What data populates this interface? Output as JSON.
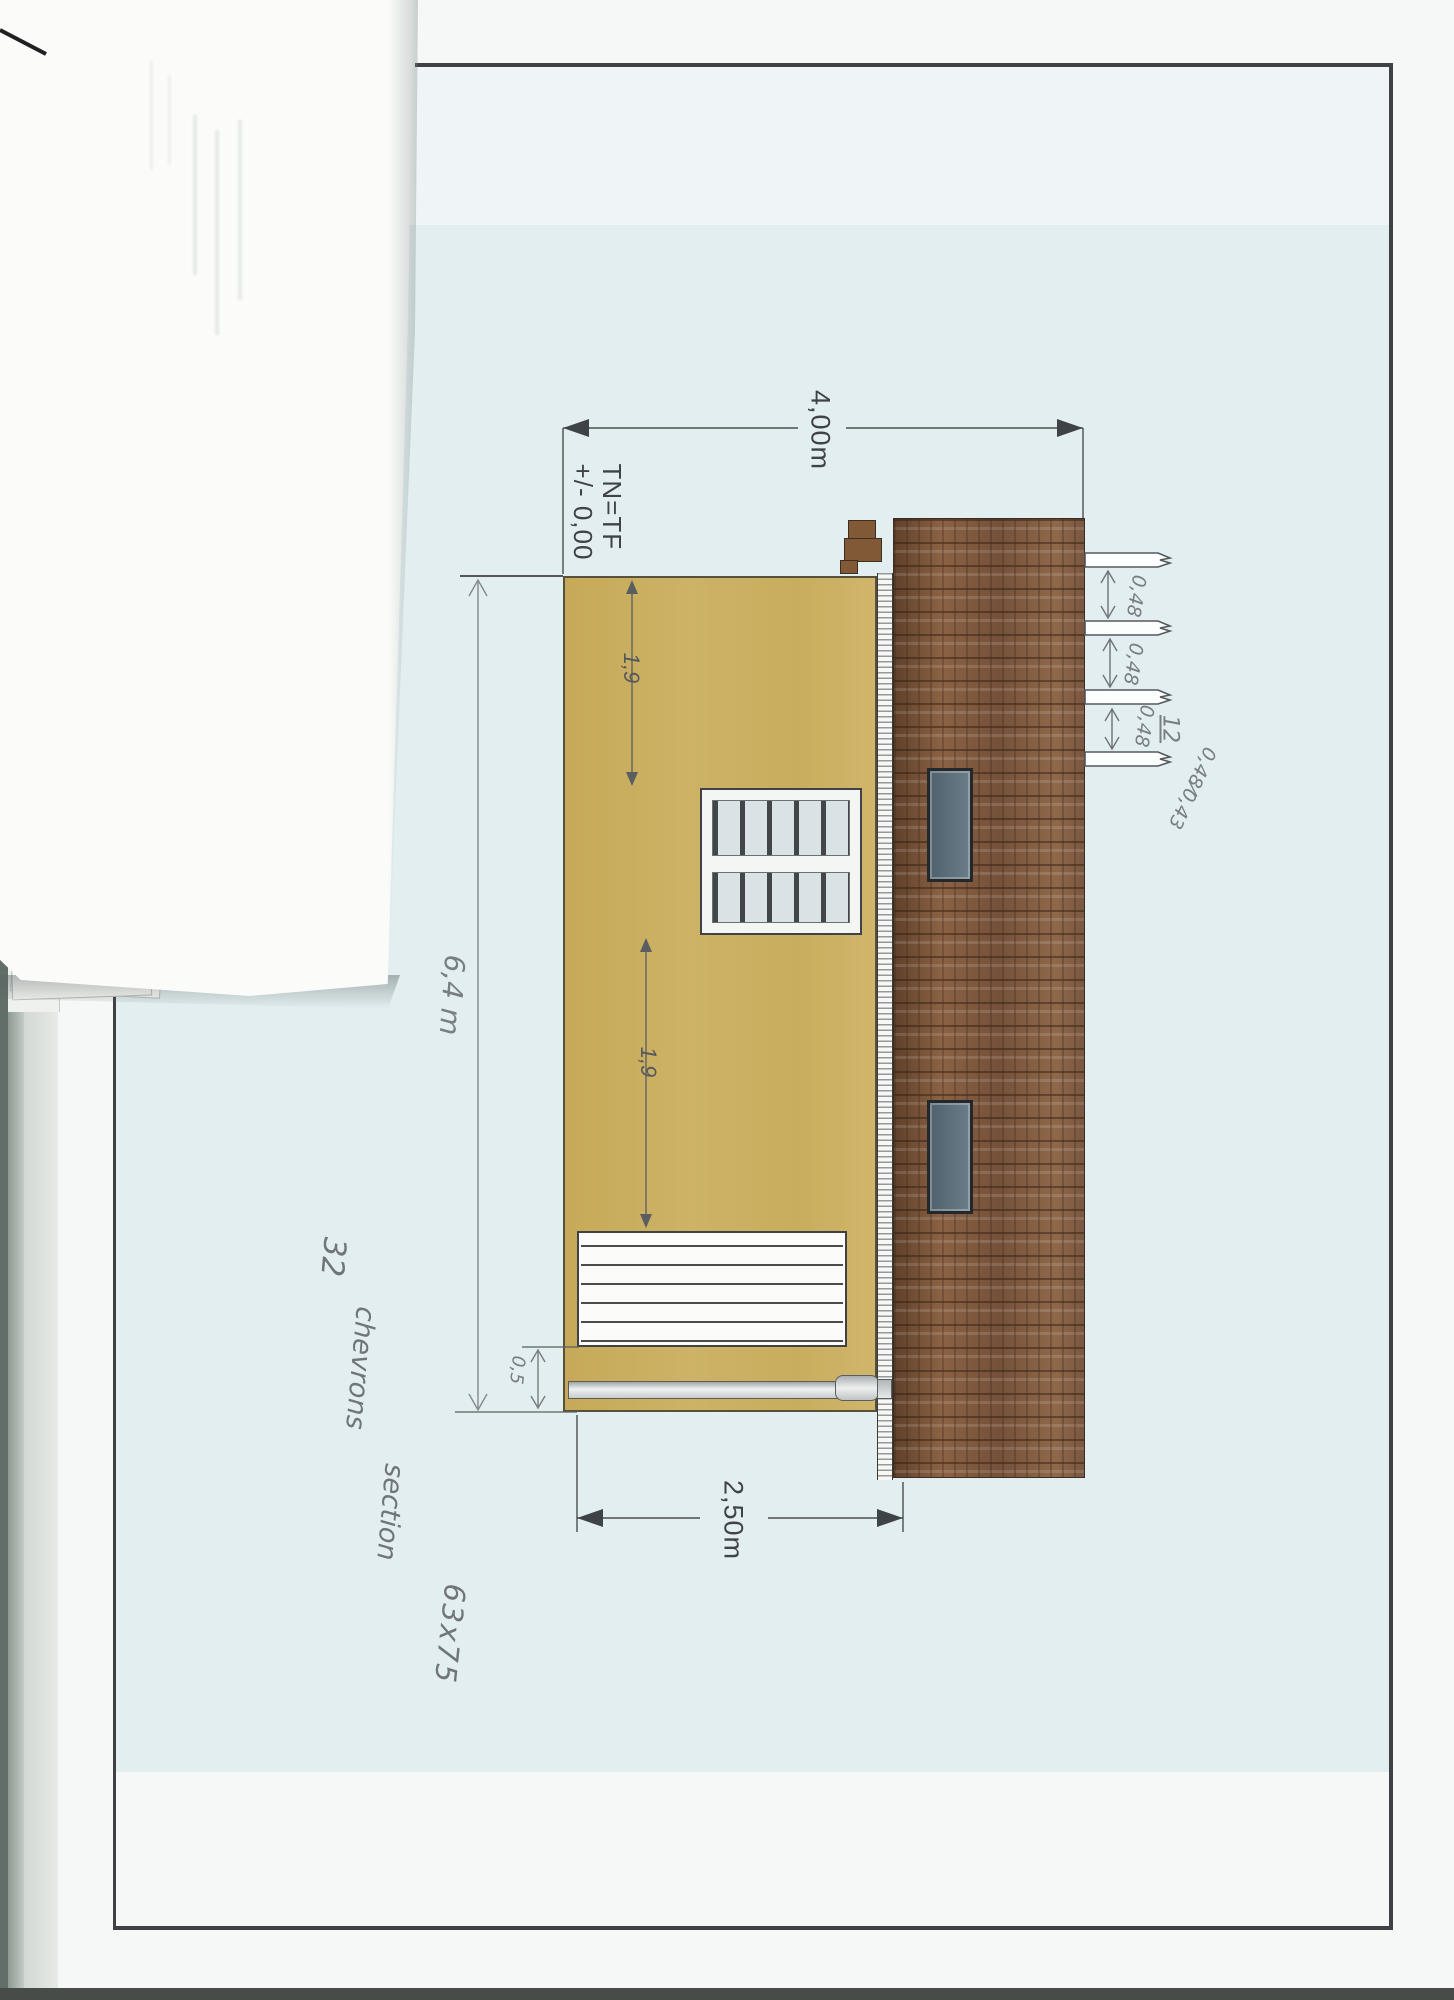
{
  "document": {
    "kind": "scanned architectural elevation drawing, rotated 90 degrees on page",
    "colors": {
      "wall_yellow": "#c9ad5e",
      "roof_brown": "#7a5438",
      "drawing_background_blue": "#e3eef0",
      "skylight_gray": "#5c6f7a",
      "page_white": "#f5f8f7",
      "border_dark": "#3f4244"
    }
  },
  "dimensions": {
    "ridge_height": "4,00m",
    "eave_height": "2,50m",
    "ground_level_line1": "TN=TF",
    "ground_level_line2": "+/- 0,00",
    "window_offset_upper": "1,9",
    "window_offset_lower": "1,9",
    "building_length": "6,4 m",
    "door_end_offset": "0,5"
  },
  "handwritten": {
    "rafter_spacing": [
      "0,48",
      "0,48",
      "0,48"
    ],
    "rafter_count_calc": "12",
    "calc_fraction_top": "0,48",
    "calc_fraction_slash": "⁄",
    "calc_fraction_bottom": "0,43",
    "note_line1": "32",
    "note_line2": "chevrons",
    "note_line3": "section",
    "note_line4": "63x75"
  }
}
